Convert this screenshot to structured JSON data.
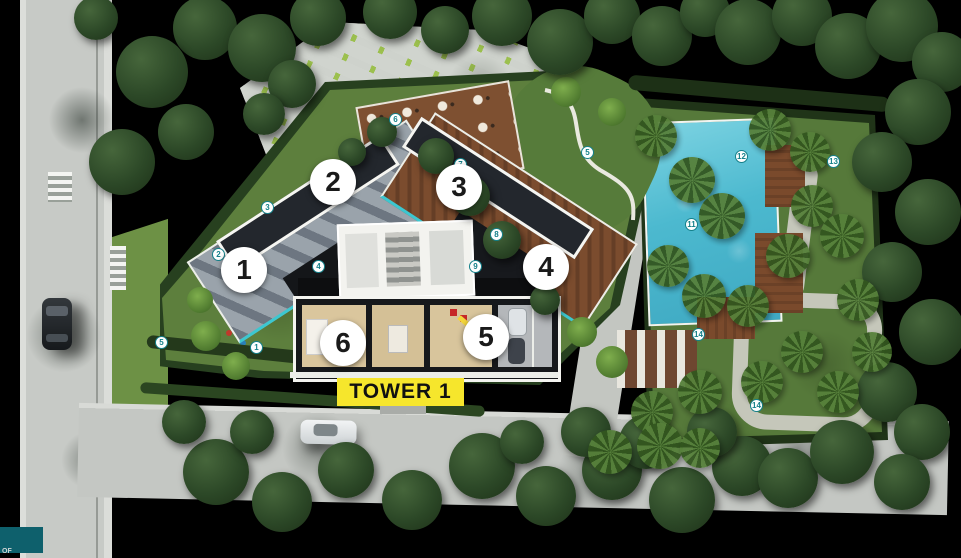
{
  "scene": {
    "description": "Aerial master-plan render of Tower 1 residential compound with pool garden",
    "tower_label": "TOWER 1",
    "corner_text": "OF",
    "colors": {
      "background": "#000000",
      "tower_label_bg": "#F6E62C",
      "tower_label_text": "#111111",
      "unit_marker_bg": "#FFFFFF",
      "unit_marker_text": "#1A1A1A",
      "amenity_marker_accent": "#14808A",
      "pool": "#55C2D6",
      "lawn": "#5D7F3D",
      "deck_wood": "#7B4C2E",
      "deck_stone": "#9AA3AB",
      "corner_swatch": "#0E606C"
    }
  },
  "unit_markers": [
    {
      "n": "1",
      "x": 244,
      "y": 270
    },
    {
      "n": "2",
      "x": 333,
      "y": 182
    },
    {
      "n": "3",
      "x": 459,
      "y": 187
    },
    {
      "n": "4",
      "x": 546,
      "y": 267
    },
    {
      "n": "5",
      "x": 486,
      "y": 337
    },
    {
      "n": "6",
      "x": 343,
      "y": 343
    }
  ],
  "amenity_markers": [
    {
      "n": "2",
      "x": 219,
      "y": 255
    },
    {
      "n": "3",
      "x": 268,
      "y": 208
    },
    {
      "n": "5",
      "x": 162,
      "y": 343
    },
    {
      "n": "1",
      "x": 257,
      "y": 348
    },
    {
      "n": "6",
      "x": 396,
      "y": 120
    },
    {
      "n": "7",
      "x": 461,
      "y": 165
    },
    {
      "n": "8",
      "x": 497,
      "y": 235
    },
    {
      "n": "5",
      "x": 588,
      "y": 153
    },
    {
      "n": "4",
      "x": 319,
      "y": 267
    },
    {
      "n": "9",
      "x": 476,
      "y": 267
    },
    {
      "n": "11",
      "x": 692,
      "y": 225
    },
    {
      "n": "12",
      "x": 742,
      "y": 157
    },
    {
      "n": "13",
      "x": 834,
      "y": 162
    },
    {
      "n": "14",
      "x": 699,
      "y": 335
    },
    {
      "n": "14",
      "x": 757,
      "y": 406
    }
  ]
}
